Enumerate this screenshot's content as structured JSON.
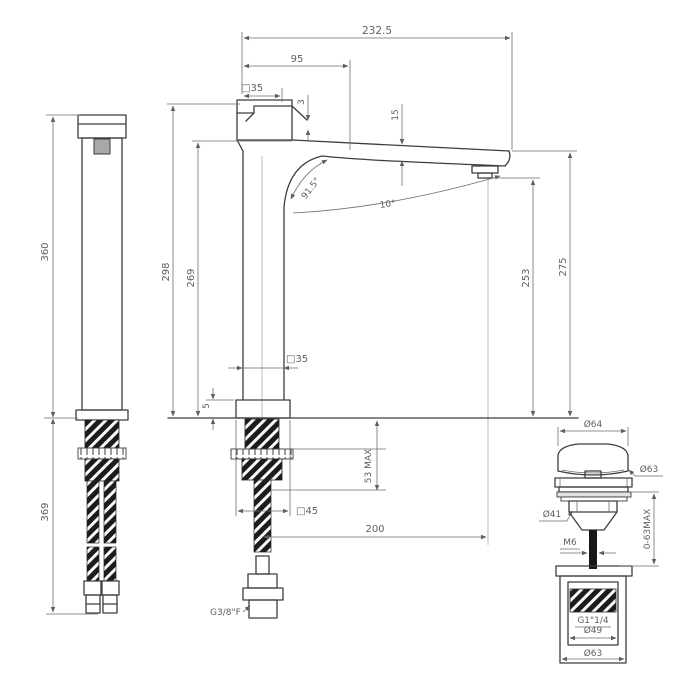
{
  "front": {
    "overall_depth": "232.5",
    "spout_offset": "95",
    "handle_width": "□35",
    "top_step": "3",
    "spout_thickness": "15",
    "handle_angle": "91.5°",
    "spout_angle": "10°",
    "height_to_handle": "298",
    "height_to_spout_base": "269",
    "outlet_height": "253",
    "spout_top_height": "275",
    "body_width": "□35",
    "base_thickness": "5",
    "deck_max": "53 MAX",
    "base_width": "□45",
    "spout_reach": "200",
    "inlet_thread": "G3/8\"F"
  },
  "side": {
    "height_above_deck": "360",
    "hose_length": "369"
  },
  "waste": {
    "cap_diameter": "Ø64",
    "flange_diameter": "Ø63",
    "body_diameter": "Ø41",
    "adjust_range": "0-63MAX",
    "rod_thread": "M6",
    "waste_thread": "G1\"1/4",
    "inner_diameter": "Ø49",
    "outer_diameter": "Ø63"
  }
}
